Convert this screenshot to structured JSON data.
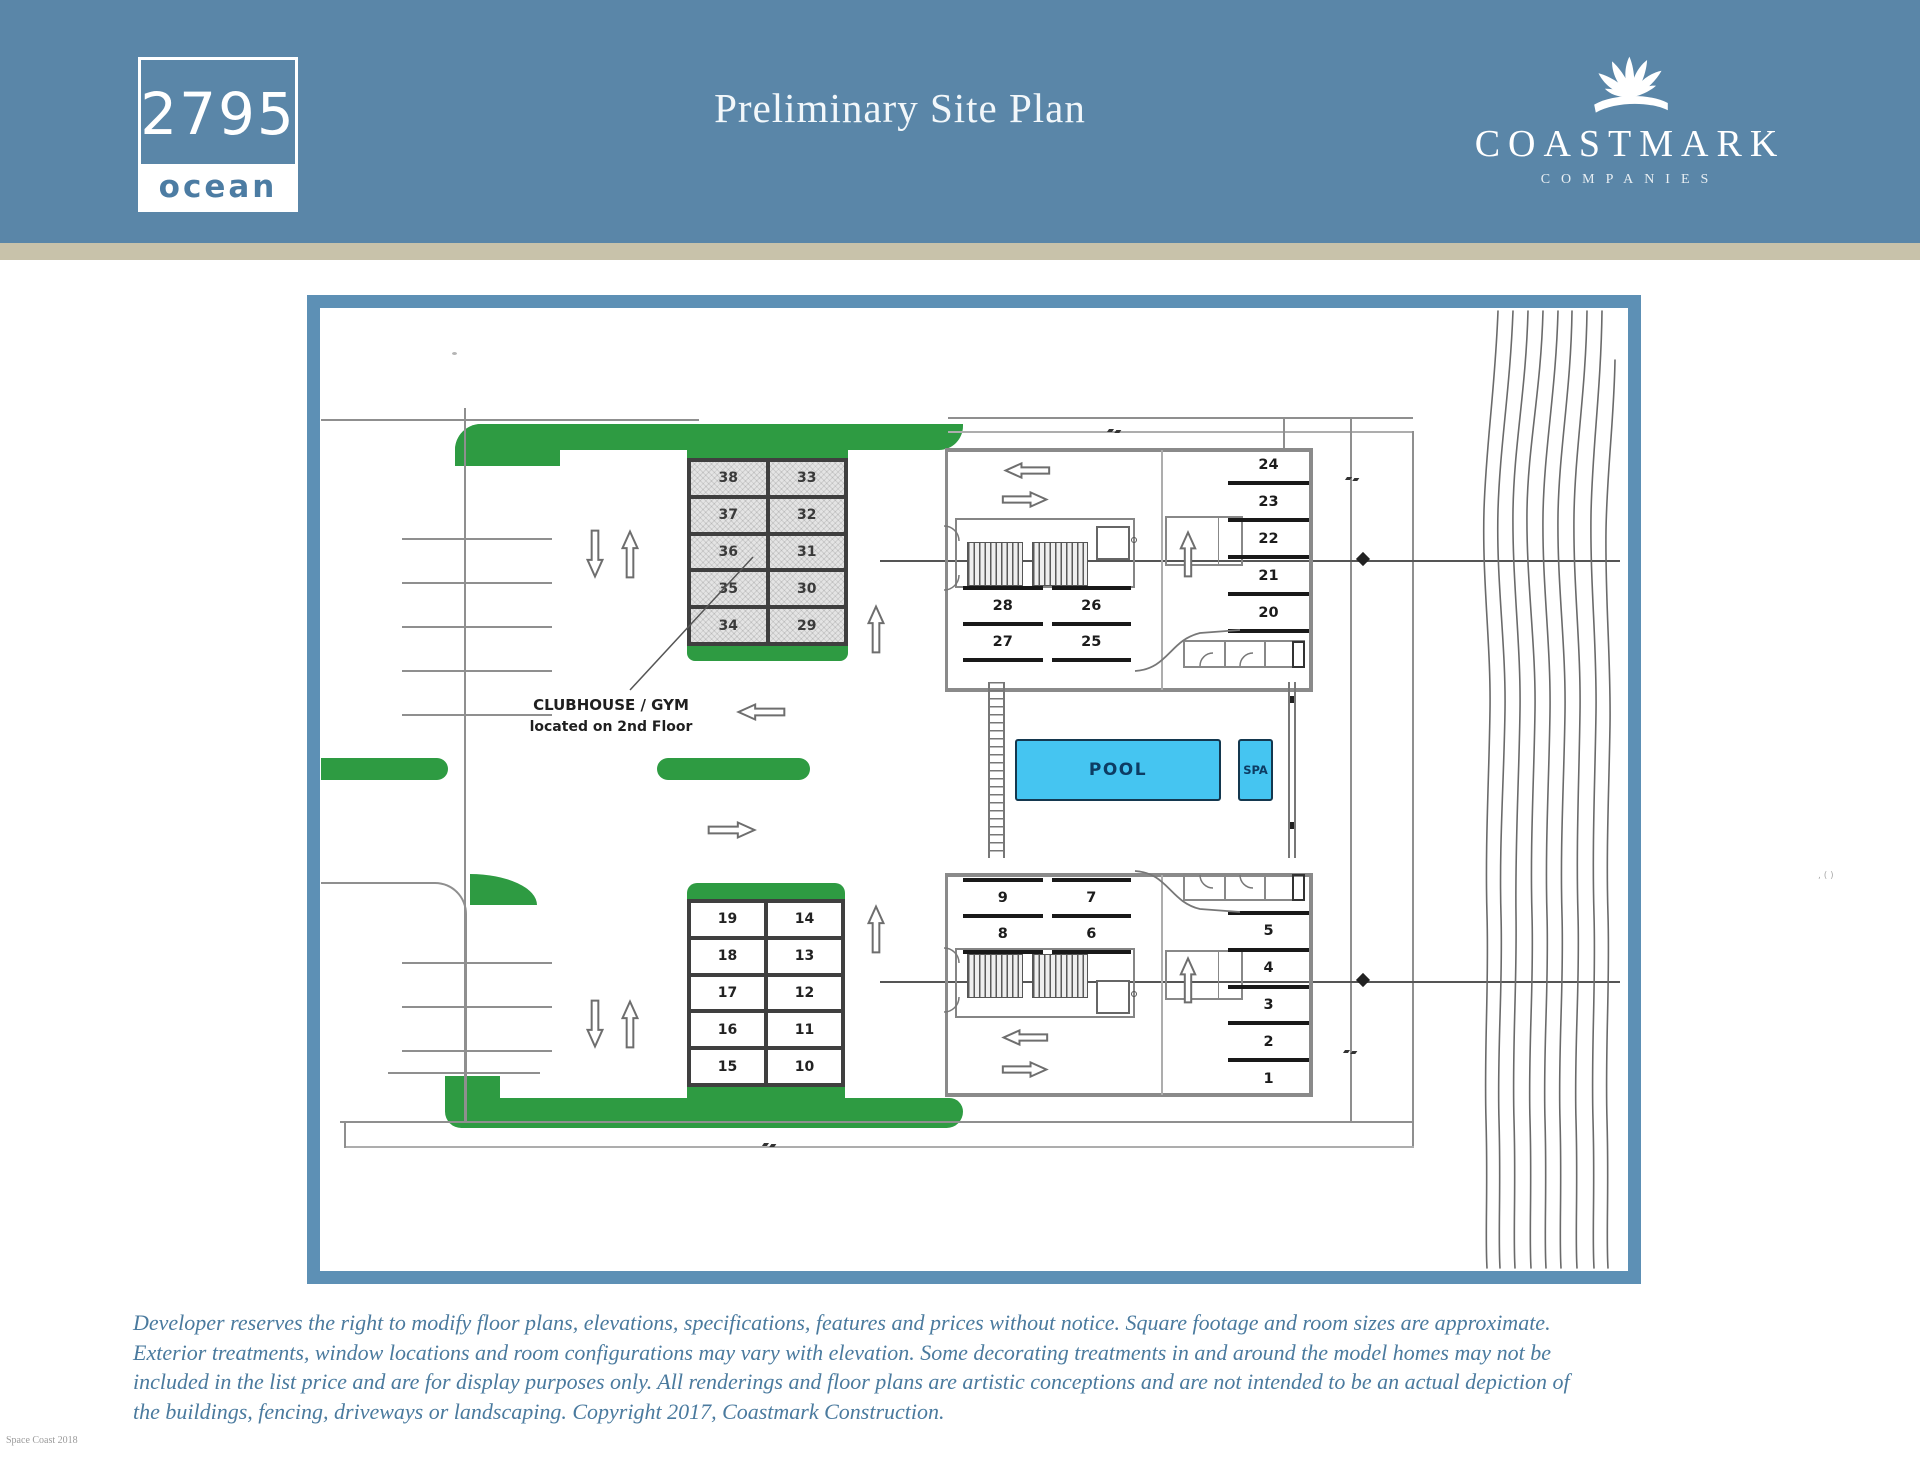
{
  "header": {
    "logo": {
      "number": "2795",
      "word": "ocean"
    },
    "title": "Preliminary Site Plan",
    "brand": {
      "name": "COASTMARK",
      "subtitle": "COMPANIES"
    }
  },
  "plan": {
    "clubhouse_note": {
      "line1": "CLUBHOUSE / GYM",
      "line2": "located on 2nd Floor"
    },
    "pool_label": "POOL",
    "spa_label": "SPA",
    "garage_upper": {
      "rows": [
        [
          "38",
          "33"
        ],
        [
          "37",
          "32"
        ],
        [
          "36",
          "31"
        ],
        [
          "35",
          "30"
        ],
        [
          "34",
          "29"
        ]
      ]
    },
    "garage_lower": {
      "rows": [
        [
          "19",
          "14"
        ],
        [
          "18",
          "13"
        ],
        [
          "17",
          "12"
        ],
        [
          "16",
          "11"
        ],
        [
          "15",
          "10"
        ]
      ]
    },
    "building_upper": {
      "stall_rows": [
        [
          "28",
          "26"
        ],
        [
          "27",
          "25"
        ]
      ],
      "east_stalls": [
        "24",
        "23",
        "22",
        "21",
        "20"
      ]
    },
    "building_lower": {
      "stall_rows": [
        [
          "9",
          "7"
        ],
        [
          "8",
          "6"
        ]
      ],
      "east_stalls": [
        "5",
        "4",
        "3",
        "2",
        "1"
      ]
    }
  },
  "footer": {
    "disclaimer_lines": [
      "Developer reserves the right to modify floor plans, elevations, specifications, features and prices without notice. Square footage and room sizes are approximate.",
      "Exterior treatments, window locations and room configurations may vary with elevation. Some decorating treatments in and around the model homes may not be",
      "included in the list price and are for display purposes only. All renderings and floor plans are artistic conceptions and are not intended to be an actual depiction of",
      "the buildings, fencing, driveways or landscaping. Copyright 2017, Coastmark Construction."
    ],
    "watermark": "Space Coast 2018",
    "stray_mark": ", ( )"
  },
  "colors": {
    "header_blue": "#5a86a8",
    "band_tan": "#c8c2aa",
    "frame_blue": "#5d90b5",
    "landscape_green": "#2e9b42",
    "pool_cyan": "#45c5f1",
    "disclaimer_blue": "#4a7a9e"
  },
  "icons": {
    "brand_logo": "shell-rays-over-wave-icon"
  }
}
